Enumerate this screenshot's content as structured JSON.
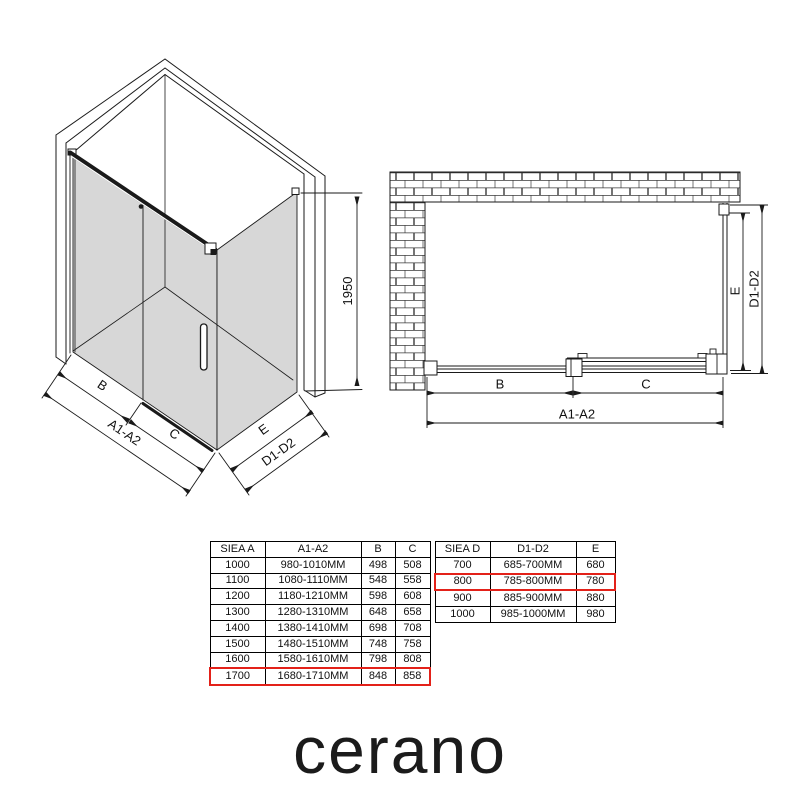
{
  "brand": {
    "logo": "cerano"
  },
  "colors": {
    "highlight_red": "#e32119",
    "glass_gray": "#d7d7d7",
    "line_black": "#1a1a1a"
  },
  "isometric": {
    "label_b": "B",
    "label_c": "C",
    "label_a1a2": "A1-A2",
    "label_e": "E",
    "label_d1d2": "D1-D2",
    "label_height": "1950"
  },
  "plan": {
    "label_b": "B",
    "label_c": "C",
    "label_a1a2": "A1-A2",
    "label_e": "E",
    "label_d1d2": "D1-D2"
  },
  "tables": {
    "width_table": {
      "headers": [
        "SIEA A",
        "A1-A2",
        "B",
        "C"
      ],
      "rows": [
        [
          "1000",
          "980-1010MM",
          "498",
          "508"
        ],
        [
          "1100",
          "1080-1110MM",
          "548",
          "558"
        ],
        [
          "1200",
          "1180-1210MM",
          "598",
          "608"
        ],
        [
          "1300",
          "1280-1310MM",
          "648",
          "658"
        ],
        [
          "1400",
          "1380-1410MM",
          "698",
          "708"
        ],
        [
          "1500",
          "1480-1510MM",
          "748",
          "758"
        ],
        [
          "1600",
          "1580-1610MM",
          "798",
          "808"
        ],
        [
          "1700",
          "1680-1710MM",
          "848",
          "858"
        ]
      ],
      "highlighted_row": "1700"
    },
    "depth_table": {
      "headers": [
        "SIEA D",
        "D1-D2",
        "E"
      ],
      "rows": [
        [
          "700",
          "685-700MM",
          "680"
        ],
        [
          "800",
          "785-800MM",
          "780"
        ],
        [
          "900",
          "885-900MM",
          "880"
        ],
        [
          "1000",
          "985-1000MM",
          "980"
        ]
      ],
      "highlighted_row": "800"
    }
  }
}
